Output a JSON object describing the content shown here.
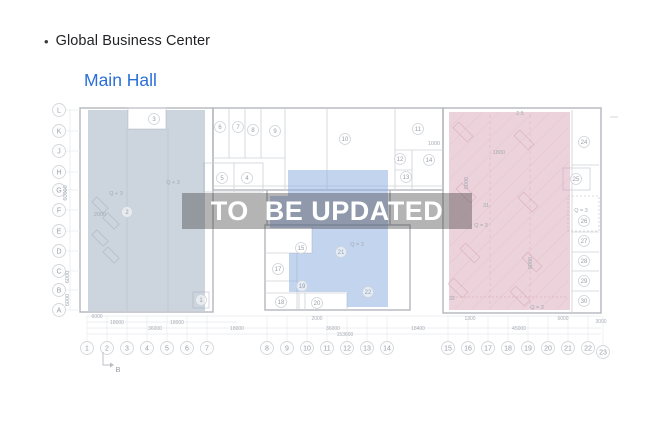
{
  "header": {
    "bullet": "•",
    "title": "Global Business Center"
  },
  "subtitle": {
    "label": "Main Hall"
  },
  "watermark": {
    "text": "TO  BE UPDATED"
  },
  "colors": {
    "title_text": "#1f2124",
    "subtitle_blue": "#2b6fd9",
    "watermark_bg": "rgba(58,58,60,0.38)",
    "watermark_text": "#ffffff",
    "zone_left": "rgba(153,169,187,0.5)",
    "zone_middle": "rgba(135,169,223,0.5)",
    "zone_right": "rgba(213,155,173,0.45)"
  },
  "plan": {
    "grid_rows": [
      {
        "l": "L",
        "y": 110
      },
      {
        "l": "K",
        "y": 131
      },
      {
        "l": "J",
        "y": 151
      },
      {
        "l": "H",
        "y": 172
      },
      {
        "l": "G",
        "y": 190
      },
      {
        "l": "F",
        "y": 210
      },
      {
        "l": "E",
        "y": 231
      },
      {
        "l": "D",
        "y": 251
      },
      {
        "l": "C",
        "y": 271
      },
      {
        "l": "B",
        "y": 290
      },
      {
        "l": "A",
        "y": 310
      }
    ],
    "grid_cols": [
      {
        "l": "1",
        "x": 87
      },
      {
        "l": "2",
        "x": 107
      },
      {
        "l": "3",
        "x": 127
      },
      {
        "l": "4",
        "x": 147
      },
      {
        "l": "5",
        "x": 167
      },
      {
        "l": "6",
        "x": 187
      },
      {
        "l": "7",
        "x": 207
      },
      {
        "l": "8",
        "x": 267
      },
      {
        "l": "9",
        "x": 287
      },
      {
        "l": "10",
        "x": 307
      },
      {
        "l": "11",
        "x": 327
      },
      {
        "l": "12",
        "x": 347
      },
      {
        "l": "13",
        "x": 367
      },
      {
        "l": "14",
        "x": 387
      },
      {
        "l": "15",
        "x": 448
      },
      {
        "l": "16",
        "x": 468
      },
      {
        "l": "17",
        "x": 488
      },
      {
        "l": "18",
        "x": 508
      },
      {
        "l": "19",
        "x": 528
      },
      {
        "l": "20",
        "x": 548
      },
      {
        "l": "21",
        "x": 568
      },
      {
        "l": "22",
        "x": 588
      },
      {
        "l": "23",
        "x": 603,
        "y": 352
      }
    ],
    "rooms": [
      {
        "n": "1",
        "x": 201,
        "y": 300
      },
      {
        "n": "2",
        "x": 127,
        "y": 212
      },
      {
        "n": "3",
        "x": 154,
        "y": 119
      },
      {
        "n": "5",
        "x": 222,
        "y": 178
      },
      {
        "n": "4",
        "x": 247,
        "y": 178
      },
      {
        "n": "6",
        "x": 220,
        "y": 127
      },
      {
        "n": "7",
        "x": 238,
        "y": 127
      },
      {
        "n": "8",
        "x": 253,
        "y": 130
      },
      {
        "n": "9",
        "x": 275,
        "y": 131
      },
      {
        "n": "10",
        "x": 345,
        "y": 139
      },
      {
        "n": "11",
        "x": 418,
        "y": 129
      },
      {
        "n": "12",
        "x": 400,
        "y": 159
      },
      {
        "n": "13",
        "x": 406,
        "y": 177
      },
      {
        "n": "14",
        "x": 429,
        "y": 160
      },
      {
        "n": "15",
        "x": 301,
        "y": 248
      },
      {
        "n": "17",
        "x": 278,
        "y": 269
      },
      {
        "n": "18",
        "x": 281,
        "y": 302
      },
      {
        "n": "19",
        "x": 302,
        "y": 286
      },
      {
        "n": "20",
        "x": 317,
        "y": 303
      },
      {
        "n": "21",
        "x": 341,
        "y": 252
      },
      {
        "n": "22",
        "x": 368,
        "y": 292
      },
      {
        "n": "24",
        "x": 584,
        "y": 142
      },
      {
        "n": "25",
        "x": 576,
        "y": 179
      },
      {
        "n": "26",
        "x": 584,
        "y": 221
      },
      {
        "n": "27",
        "x": 584,
        "y": 241
      },
      {
        "n": "28",
        "x": 584,
        "y": 261
      },
      {
        "n": "29",
        "x": 584,
        "y": 281
      },
      {
        "n": "30",
        "x": 584,
        "y": 301
      }
    ],
    "notes": [
      {
        "t": "Q + 3",
        "x": 173,
        "y": 184
      },
      {
        "t": "Q + 3",
        "x": 116,
        "y": 195
      },
      {
        "t": "2000",
        "x": 100,
        "y": 216
      },
      {
        "t": "Q = 3",
        "x": 357,
        "y": 246
      },
      {
        "t": "Q = 3",
        "x": 481,
        "y": 227
      },
      {
        "t": "Q = 3",
        "x": 581,
        "y": 212
      },
      {
        "t": "Q = 3",
        "x": 537,
        "y": 309
      },
      {
        "t": "2.5",
        "x": 520,
        "y": 115
      },
      {
        "t": "1800",
        "x": 499,
        "y": 154
      },
      {
        "t": "1000",
        "x": 434,
        "y": 145
      },
      {
        "t": "31",
        "x": 486,
        "y": 207
      },
      {
        "t": "32",
        "x": 452,
        "y": 300
      },
      {
        "t": "6000",
        "x": 468,
        "y": 183,
        "rot": -90
      },
      {
        "t": "6000",
        "x": 532,
        "y": 263,
        "rot": -90
      },
      {
        "t": "60000",
        "x": 67,
        "y": 193,
        "rot": -90
      },
      {
        "t": "6000",
        "x": 69,
        "y": 277,
        "rot": -90
      },
      {
        "t": "6000",
        "x": 69,
        "y": 300,
        "rot": -90
      }
    ],
    "dims": [
      {
        "t": "6000",
        "x": 97,
        "y": 318
      },
      {
        "t": "18000",
        "x": 117,
        "y": 324
      },
      {
        "t": "18000",
        "x": 177,
        "y": 324
      },
      {
        "t": "36000",
        "x": 155,
        "y": 330
      },
      {
        "t": "18000",
        "x": 237,
        "y": 330
      },
      {
        "t": "2000",
        "x": 317,
        "y": 320
      },
      {
        "t": "36000",
        "x": 333,
        "y": 330
      },
      {
        "t": "18400",
        "x": 418,
        "y": 330
      },
      {
        "t": "1300",
        "x": 470,
        "y": 320
      },
      {
        "t": "45000",
        "x": 519,
        "y": 330
      },
      {
        "t": "6000",
        "x": 563,
        "y": 320
      },
      {
        "t": "3000",
        "x": 601,
        "y": 323
      },
      {
        "t": "153600",
        "x": 345,
        "y": 336
      }
    ],
    "section_marker": {
      "label": "B"
    }
  }
}
